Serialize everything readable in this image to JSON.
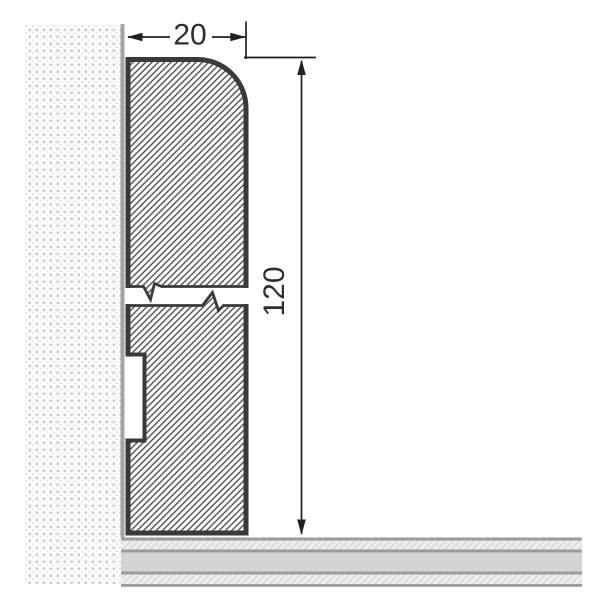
{
  "drawing": {
    "type": "technical-cross-section",
    "subject": "skirting-board profile mounted on wall above floor",
    "dimensions": {
      "width_label": "20",
      "height_label": "120"
    },
    "features": {
      "break_symbol": "profile shortened with zigzag break lines",
      "rear_groove": "rectangular cable groove on wall side of lower section",
      "rounded_edge": "top outer corner rounded"
    },
    "colors": {
      "outline": "#3a3a3a",
      "hatch_line": "#4a4a4a",
      "dimension_line": "#1f1f1f",
      "wall_background": "#fafafa",
      "wall_dot": "#c9c9c9",
      "wall_edge": "#a5a5a5",
      "floor_border": "#9c9c9c",
      "floor_solid": "#d4d4d4",
      "floor_hatch_bg": "#efefef",
      "floor_hatch_line": "#d9d9d9",
      "background": "#ffffff"
    }
  }
}
